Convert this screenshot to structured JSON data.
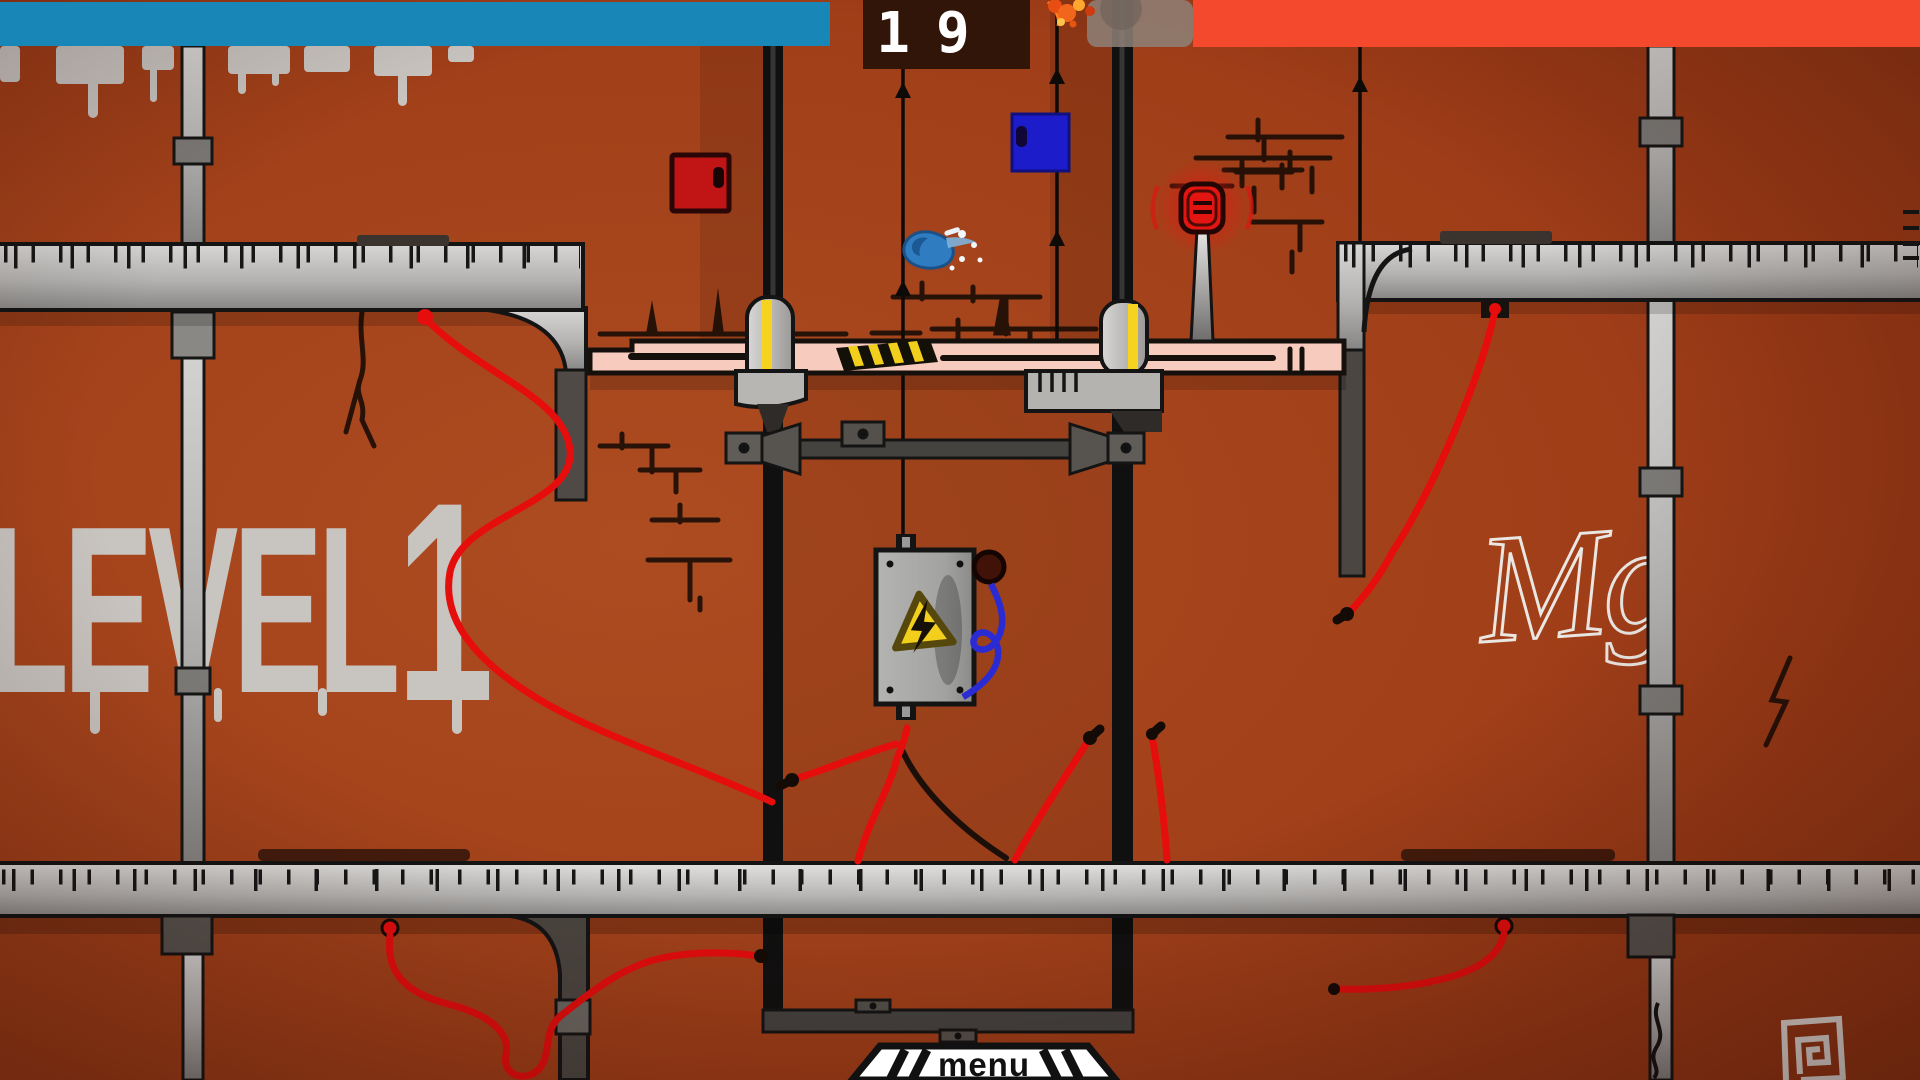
{
  "hud": {
    "blue_health_bar": {
      "color": "#1886b7"
    },
    "red_health_bar": {
      "color": "#f5492d"
    },
    "timer": {
      "value": "19"
    }
  },
  "wall": {
    "color": "#9c3a16",
    "graffiti_word": "LEVEL",
    "graffiti_number": "1",
    "tag": "Mg"
  },
  "menu_button": {
    "label": "menu"
  },
  "palette": {
    "platform_pink": "#f7cbbd",
    "hazard_yellow": "#f2cf1d",
    "piston_yellow": "#f5d31f",
    "wire_red": "#e60d0d",
    "wire_blue": "#2b2bd4",
    "door_red": "#c11414",
    "door_blue": "#1c1ccb",
    "splat_blue": "#2f7dc0",
    "lamp_red": "#e31511",
    "metal_gray": "#c9c7c4",
    "pole_black": "#101010"
  }
}
